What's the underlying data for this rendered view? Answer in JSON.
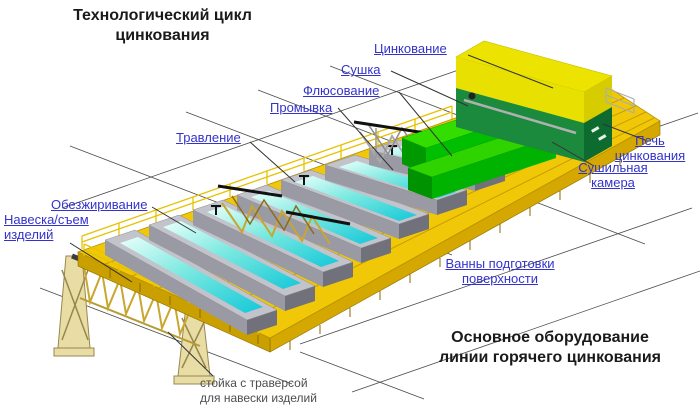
{
  "title_top": {
    "line1": "Технологический цикл",
    "line2": "цинкования"
  },
  "title_bottom": {
    "line1": "Основное оборудование",
    "line2": "линии горячего цинкования"
  },
  "process_labels": {
    "zinc": "Цинкование",
    "drying": "Сушка",
    "fluxing": "Флюсование",
    "rinsing": "Промывка",
    "pickling": "Травление",
    "degreasing": "Обезжиривание",
    "loading": {
      "line1": "Навеска/съем",
      "line2": "изделий"
    }
  },
  "equipment_labels": {
    "furnace": {
      "line1": "Печь",
      "line2": "цинкования"
    },
    "drying_chamber": {
      "line1": "Сушильная",
      "line2": "камера"
    },
    "prep_baths": {
      "line1": "Ванны подготовки",
      "line2": "поверхности"
    }
  },
  "caption_stand": {
    "line1": "стойка с траверсой",
    "line2": "для навески изделий"
  },
  "illustration": {
    "bath_count": 7,
    "view": "isometric"
  },
  "colors": {
    "label_blue": "#3333cc",
    "title_black": "#1a1a1a",
    "platform_yellow": "#f0c808",
    "water_cyan": "#14c8d8",
    "chamber_green": "#22cc00",
    "furnace_green": "#1b8a3c",
    "furnace_yellow": "#ece400",
    "caption_gray": "#4d4d4d"
  }
}
